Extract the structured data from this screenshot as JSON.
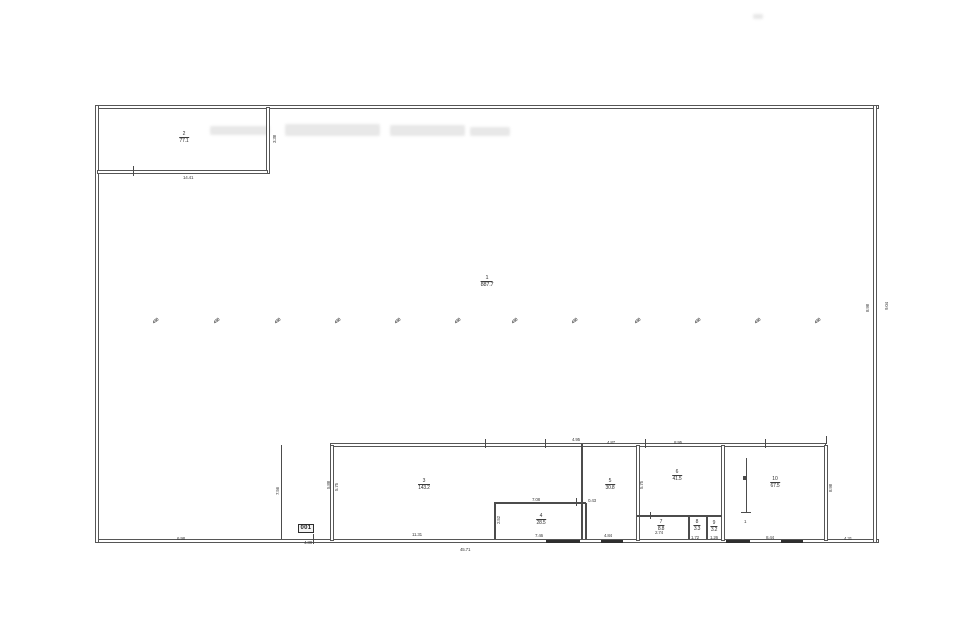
{
  "meta": {
    "background": "#ffffff",
    "ink_color": "#4c4c4c",
    "drawing_type": "scanned floor plan"
  },
  "rooms": [
    {
      "id": "room-1-hall",
      "num": "1",
      "area": "887.7",
      "x": 487,
      "y": 276,
      "big": true
    },
    {
      "id": "room-2",
      "num": "2",
      "area": "77.1",
      "x": 184,
      "y": 132,
      "big": false
    },
    {
      "id": "room-3",
      "num": "3",
      "area": "143.2",
      "x": 424,
      "y": 479,
      "big": false
    },
    {
      "id": "room-4",
      "num": "4",
      "area": "28.5",
      "x": 541,
      "y": 514,
      "big": false
    },
    {
      "id": "room-5",
      "num": "5",
      "area": "30.8",
      "x": 610,
      "y": 479,
      "big": false
    },
    {
      "id": "room-6",
      "num": "6",
      "area": "41.5",
      "x": 677,
      "y": 470,
      "big": false
    },
    {
      "id": "room-7",
      "num": "7",
      "area": "8.8",
      "x": 661,
      "y": 520,
      "big": false
    },
    {
      "id": "room-8",
      "num": "8",
      "area": "3.3",
      "x": 697,
      "y": 520,
      "big": false
    },
    {
      "id": "room-9",
      "num": "9",
      "area": "3.2",
      "x": 714,
      "y": 521,
      "big": false
    },
    {
      "id": "room-10",
      "num": "10",
      "area": "67.5",
      "x": 775,
      "y": 477,
      "big": false
    }
  ],
  "door_label": {
    "text": "001",
    "x": 298,
    "y": 524
  },
  "dims": [
    {
      "text": "14.41",
      "x": 183,
      "y": 175,
      "rot": false
    },
    {
      "text": "3.38",
      "x": 272,
      "y": 143,
      "rot": true
    },
    {
      "text": "6.98",
      "x": 177,
      "y": 536,
      "rot": false
    },
    {
      "text": "4.38",
      "x": 304,
      "y": 540,
      "rot": false
    },
    {
      "text": "11.31",
      "x": 412,
      "y": 532,
      "rot": false
    },
    {
      "text": "7.08",
      "x": 532,
      "y": 497,
      "rot": false
    },
    {
      "text": "7.46",
      "x": 535,
      "y": 533,
      "rot": false
    },
    {
      "text": "0.43",
      "x": 588,
      "y": 498,
      "rot": false
    },
    {
      "text": "4.84",
      "x": 604,
      "y": 533,
      "rot": false
    },
    {
      "text": "2.74",
      "x": 655,
      "y": 530,
      "rot": false
    },
    {
      "text": "1.72",
      "x": 691,
      "y": 535,
      "rot": false
    },
    {
      "text": "1.26",
      "x": 710,
      "y": 535,
      "rot": false
    },
    {
      "text": "8.44",
      "x": 766,
      "y": 535,
      "rot": false
    },
    {
      "text": "4.31",
      "x": 844,
      "y": 536,
      "rot": false
    },
    {
      "text": "45.71",
      "x": 460,
      "y": 547,
      "rot": false
    },
    {
      "text": "4.95",
      "x": 572,
      "y": 437,
      "rot": false
    },
    {
      "text": "4.87",
      "x": 607,
      "y": 440,
      "rot": false
    },
    {
      "text": "8.95",
      "x": 674,
      "y": 440,
      "rot": false
    },
    {
      "text": "7.56",
      "x": 275,
      "y": 495,
      "rot": true
    },
    {
      "text": "5.88",
      "x": 326,
      "y": 489,
      "rot": true
    },
    {
      "text": "5.75",
      "x": 334,
      "y": 491,
      "rot": true
    },
    {
      "text": "2.52",
      "x": 496,
      "y": 524,
      "rot": true
    },
    {
      "text": "5.75",
      "x": 639,
      "y": 489,
      "rot": true
    },
    {
      "text": "8.98",
      "x": 828,
      "y": 492,
      "rot": true
    },
    {
      "text": "8.98",
      "x": 865,
      "y": 312,
      "rot": true
    },
    {
      "text": "9.04",
      "x": 884,
      "y": 310,
      "rot": true
    },
    {
      "text": "1",
      "x": 744,
      "y": 519,
      "rot": false
    }
  ],
  "column_marks": {
    "label": "4.50",
    "y": 318,
    "xs": [
      152,
      213,
      274,
      334,
      394,
      454,
      511,
      571,
      634,
      694,
      754,
      814
    ]
  },
  "walls_double": [
    {
      "x": 95,
      "y": 105,
      "w": 782,
      "h": 2
    },
    {
      "x": 95,
      "y": 539,
      "w": 782,
      "h": 2
    },
    {
      "x": 95,
      "y": 105,
      "w": 2,
      "h": 436
    },
    {
      "x": 873,
      "y": 105,
      "w": 2,
      "h": 436
    },
    {
      "x": 266,
      "y": 107,
      "w": 2,
      "h": 65
    },
    {
      "x": 97,
      "y": 170,
      "w": 169,
      "h": 1.5
    },
    {
      "x": 330,
      "y": 443,
      "w": 494,
      "h": 1.5
    },
    {
      "x": 330,
      "y": 445,
      "w": 2,
      "h": 94
    },
    {
      "x": 636,
      "y": 445,
      "w": 1.5,
      "h": 94
    },
    {
      "x": 721,
      "y": 445,
      "w": 2,
      "h": 94
    },
    {
      "x": 824,
      "y": 445,
      "w": 1.5,
      "h": 94
    }
  ],
  "walls_single": [
    {
      "x": 494,
      "y": 502,
      "w": 92,
      "h": 1.5
    },
    {
      "x": 494,
      "y": 503,
      "w": 1.5,
      "h": 36
    },
    {
      "x": 585,
      "y": 503,
      "w": 1.5,
      "h": 36
    },
    {
      "x": 581,
      "y": 444,
      "w": 1.5,
      "h": 95
    },
    {
      "x": 637,
      "y": 515,
      "w": 85,
      "h": 1.5
    },
    {
      "x": 688,
      "y": 516,
      "w": 1.5,
      "h": 23
    },
    {
      "x": 706,
      "y": 516,
      "w": 1.5,
      "h": 23
    },
    {
      "x": 281,
      "y": 445,
      "w": 1,
      "h": 94
    },
    {
      "x": 746,
      "y": 458,
      "w": 1,
      "h": 55
    },
    {
      "x": 741,
      "y": 512,
      "w": 10,
      "h": 1
    }
  ],
  "ticks": [
    {
      "x": 133,
      "y": 166,
      "w": 1,
      "h": 10
    },
    {
      "x": 313,
      "y": 534,
      "w": 1,
      "h": 10
    },
    {
      "x": 485,
      "y": 439,
      "w": 1,
      "h": 9
    },
    {
      "x": 545,
      "y": 439,
      "w": 1,
      "h": 9
    },
    {
      "x": 576,
      "y": 498,
      "w": 1,
      "h": 8
    },
    {
      "x": 645,
      "y": 439,
      "w": 1,
      "h": 9
    },
    {
      "x": 765,
      "y": 439,
      "w": 1,
      "h": 9
    },
    {
      "x": 826,
      "y": 436,
      "w": 1,
      "h": 8
    },
    {
      "x": 650,
      "y": 512,
      "w": 1,
      "h": 7
    },
    {
      "x": 743,
      "y": 476,
      "w": 4,
      "h": 4
    }
  ],
  "doors": [
    {
      "x": 546,
      "y": 539.5,
      "w": 34,
      "h": 3.5
    },
    {
      "x": 601,
      "y": 539.5,
      "w": 22,
      "h": 3.5
    },
    {
      "x": 726,
      "y": 539.5,
      "w": 24,
      "h": 3.5
    },
    {
      "x": 781,
      "y": 539.5,
      "w": 22,
      "h": 3.5
    }
  ],
  "scan_artifacts": [
    {
      "x": 210,
      "y": 126,
      "w": 60,
      "h": 9
    },
    {
      "x": 285,
      "y": 124,
      "w": 95,
      "h": 12
    },
    {
      "x": 390,
      "y": 125,
      "w": 75,
      "h": 11
    },
    {
      "x": 470,
      "y": 127,
      "w": 40,
      "h": 9
    },
    {
      "x": 753,
      "y": 14,
      "w": 10,
      "h": 5
    }
  ]
}
